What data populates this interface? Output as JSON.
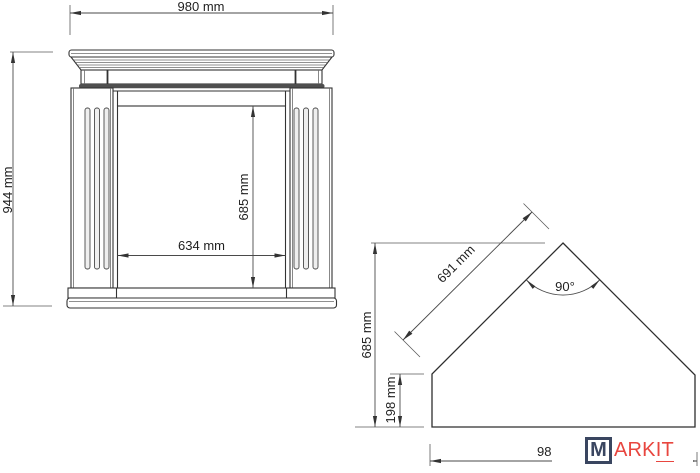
{
  "drawing": {
    "front_view": {
      "overall_width": "980 mm",
      "overall_height": "944 mm",
      "opening_height": "685 mm",
      "opening_width": "634 mm"
    },
    "corner_view": {
      "panel_width": "691 mm",
      "corner_angle": "90°",
      "overall_depth": "685 mm",
      "side_return": "198 mm",
      "back_width": "980 mm"
    }
  },
  "logo": {
    "monogram": "M",
    "wordmark_prefix": "ARK",
    "wordmark_suffix": "IT"
  },
  "colors": {
    "line": "#333333",
    "dimension_line": "#4a4a4a",
    "logo_navy": "#3a4660",
    "logo_red": "#e8463f",
    "background": "#ffffff"
  }
}
